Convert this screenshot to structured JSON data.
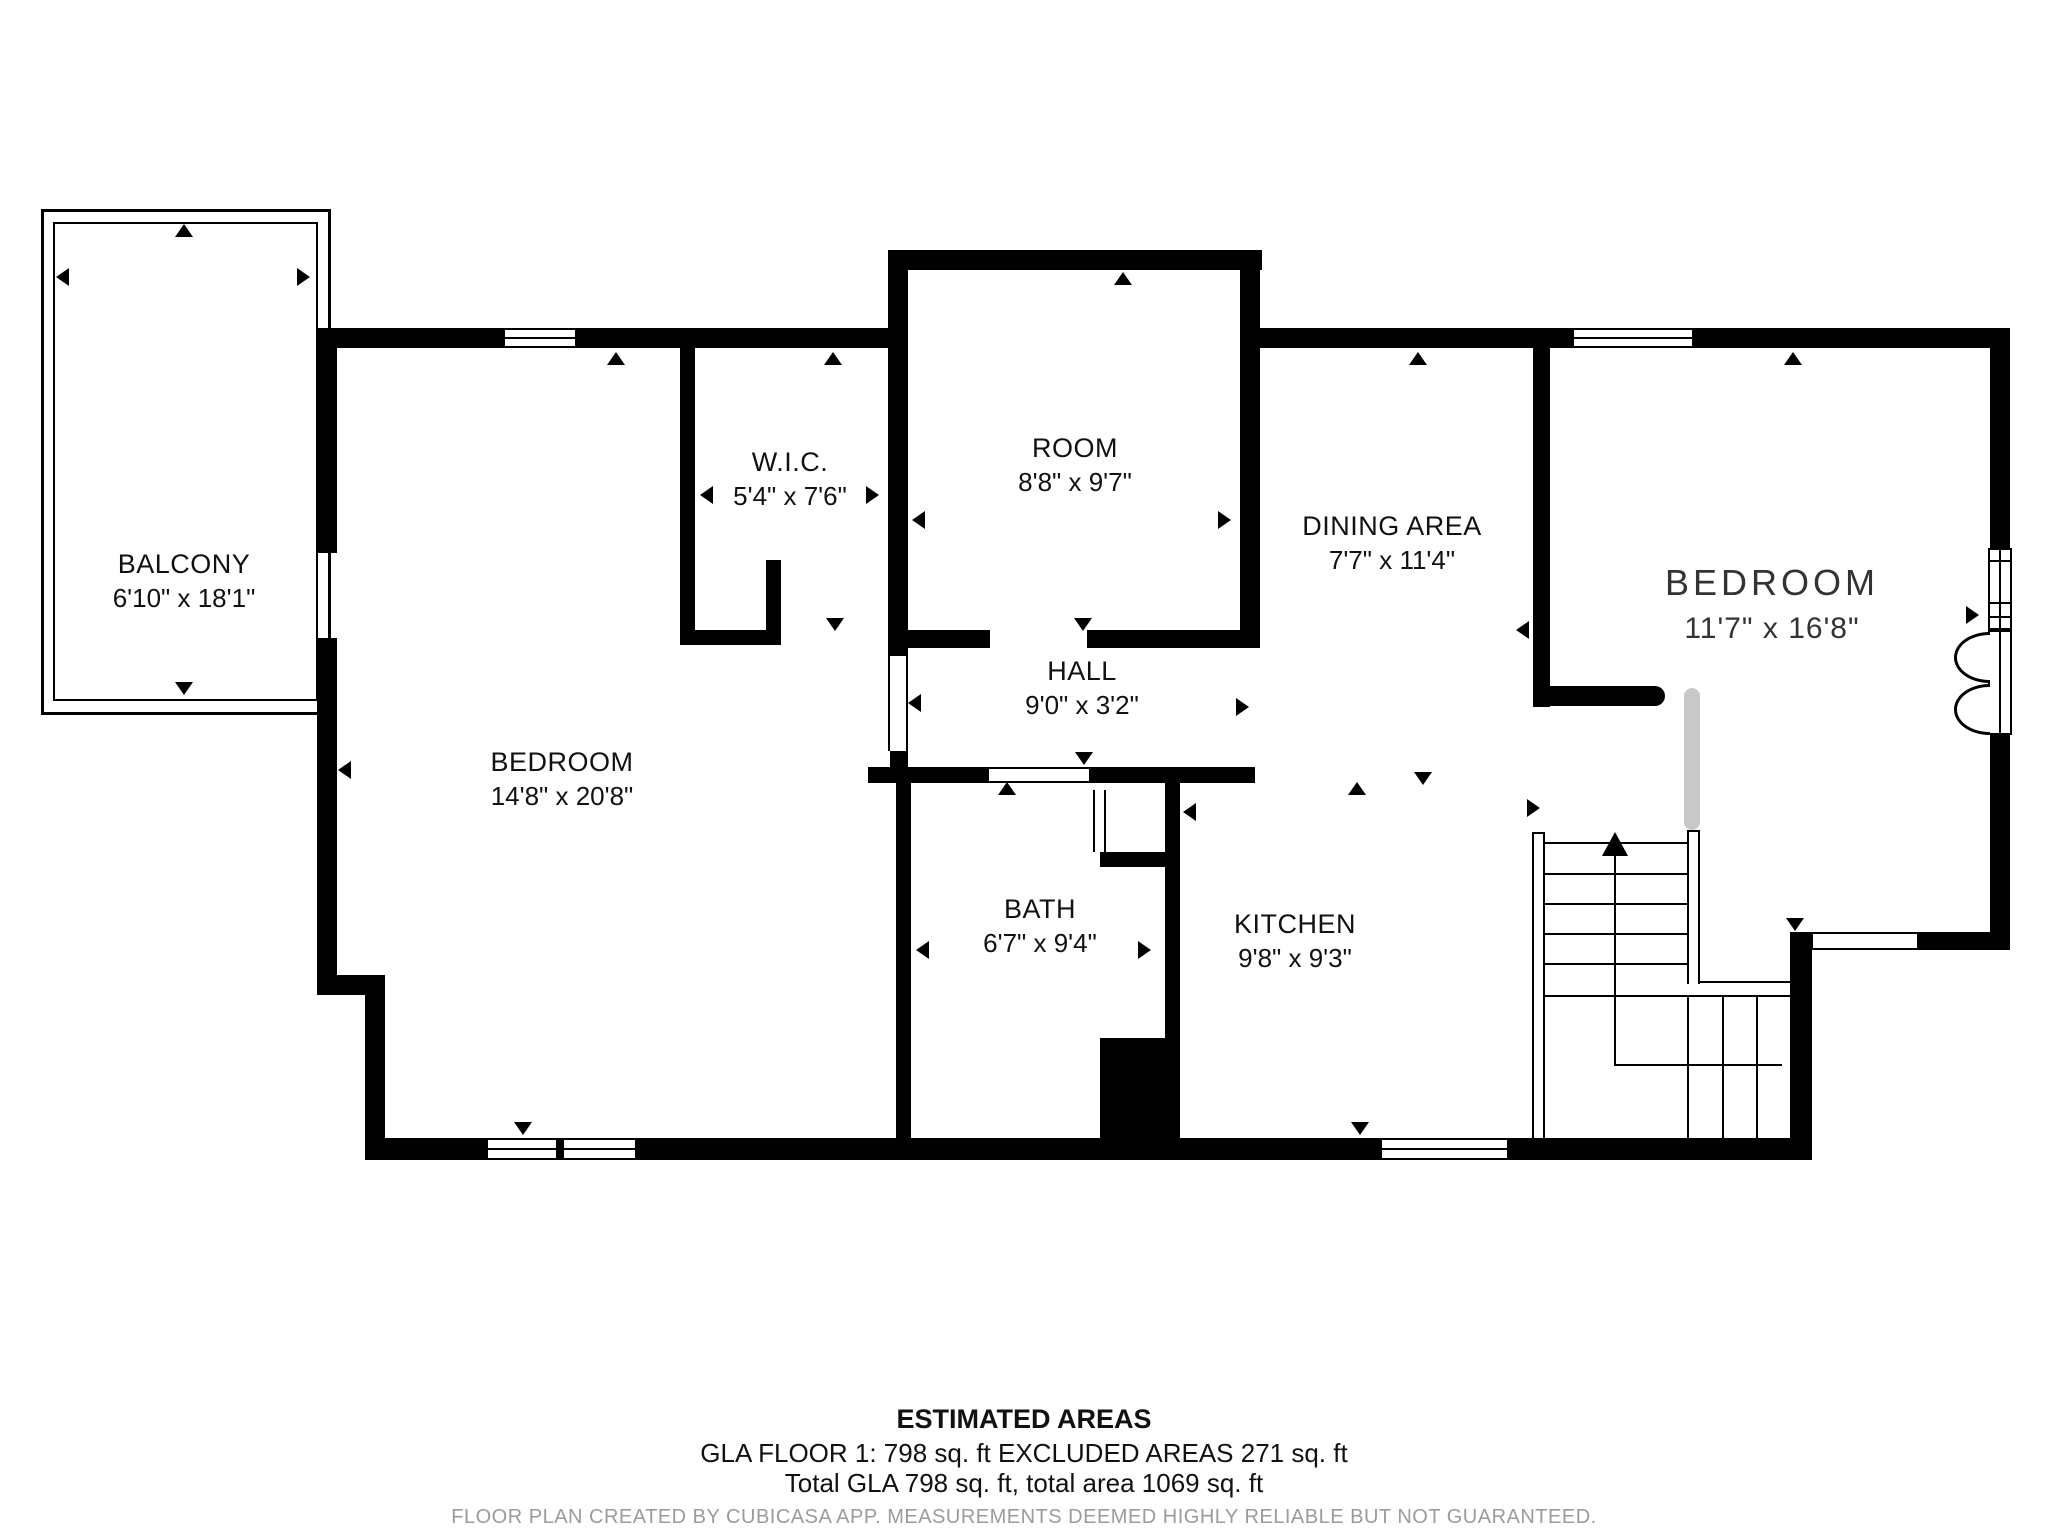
{
  "floorplan": {
    "rooms": [
      {
        "name": "BALCONY",
        "dims": "6'10\" x 18'1\""
      },
      {
        "name": "W.I.C.",
        "dims": "5'4\" x 7'6\""
      },
      {
        "name": "ROOM",
        "dims": "8'8\" x 9'7\""
      },
      {
        "name": "DINING AREA",
        "dims": "7'7\" x 11'4\""
      },
      {
        "name": "BEDROOM",
        "dims": "11'7\" x 16'8\""
      },
      {
        "name": "HALL",
        "dims": "9'0\" x 3'2\""
      },
      {
        "name": "BEDROOM",
        "dims": "14'8\" x 20'8\""
      },
      {
        "name": "BATH",
        "dims": "6'7\" x 9'4\""
      },
      {
        "name": "KITCHEN",
        "dims": "9'8\" x 9'3\""
      }
    ],
    "stairs": {
      "direction": "up"
    },
    "footer": {
      "title": "ESTIMATED AREAS",
      "line1": "GLA FLOOR 1: 798 sq. ft EXCLUDED AREAS 271 sq. ft",
      "line2": "Total GLA 798 sq. ft, total area 1069 sq. ft",
      "disclaimer": "FLOOR PLAN CREATED BY CUBICASA APP. MEASUREMENTS DEEMED HIGHLY RELIABLE BUT NOT GUARANTEED."
    },
    "colors": {
      "wall": "#000000",
      "door_leaf": "#c9c9c9",
      "disclaimer_text": "#9b9b9b",
      "background": "#ffffff"
    }
  }
}
